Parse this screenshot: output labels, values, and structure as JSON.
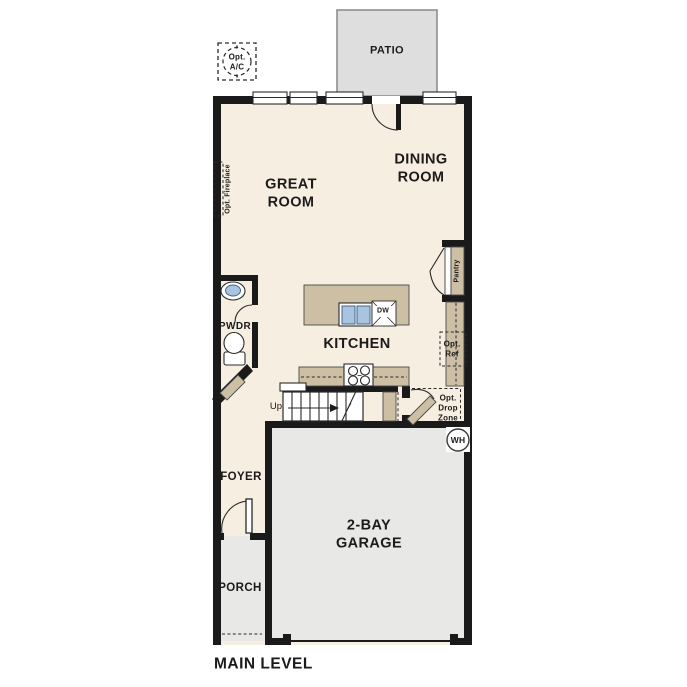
{
  "title": {
    "main_level": "MAIN LEVEL"
  },
  "rooms": {
    "patio": "PATIO",
    "great_room": "GREAT\nROOM",
    "dining_room": "DINING\nROOM",
    "kitchen": "KITCHEN",
    "pwdr": "PWDR",
    "foyer": "FOYER",
    "porch": "PORCH",
    "garage": "2-BAY\nGARAGE"
  },
  "annotations": {
    "opt_ac": "Opt.\nA/C",
    "opt_fireplace": "Opt. Fireplace",
    "pantry": "Pantry",
    "opt_ref": "Opt.\nRef",
    "opt_drop_zone": "Opt.\nDrop\nZone",
    "up": "Up",
    "dw": "DW",
    "wh": "WH"
  },
  "colors": {
    "wall": "#1a1a1a",
    "floor": "#f6eee0",
    "cabinet": "#cdbfa3",
    "garage": "#e8e8e6",
    "patio": "#dedede",
    "patio_border": "#8f8f8f",
    "sink_blue": "#a9c4de",
    "ref_gray": "#e4e4e4",
    "ink": "#1b1b1b"
  }
}
